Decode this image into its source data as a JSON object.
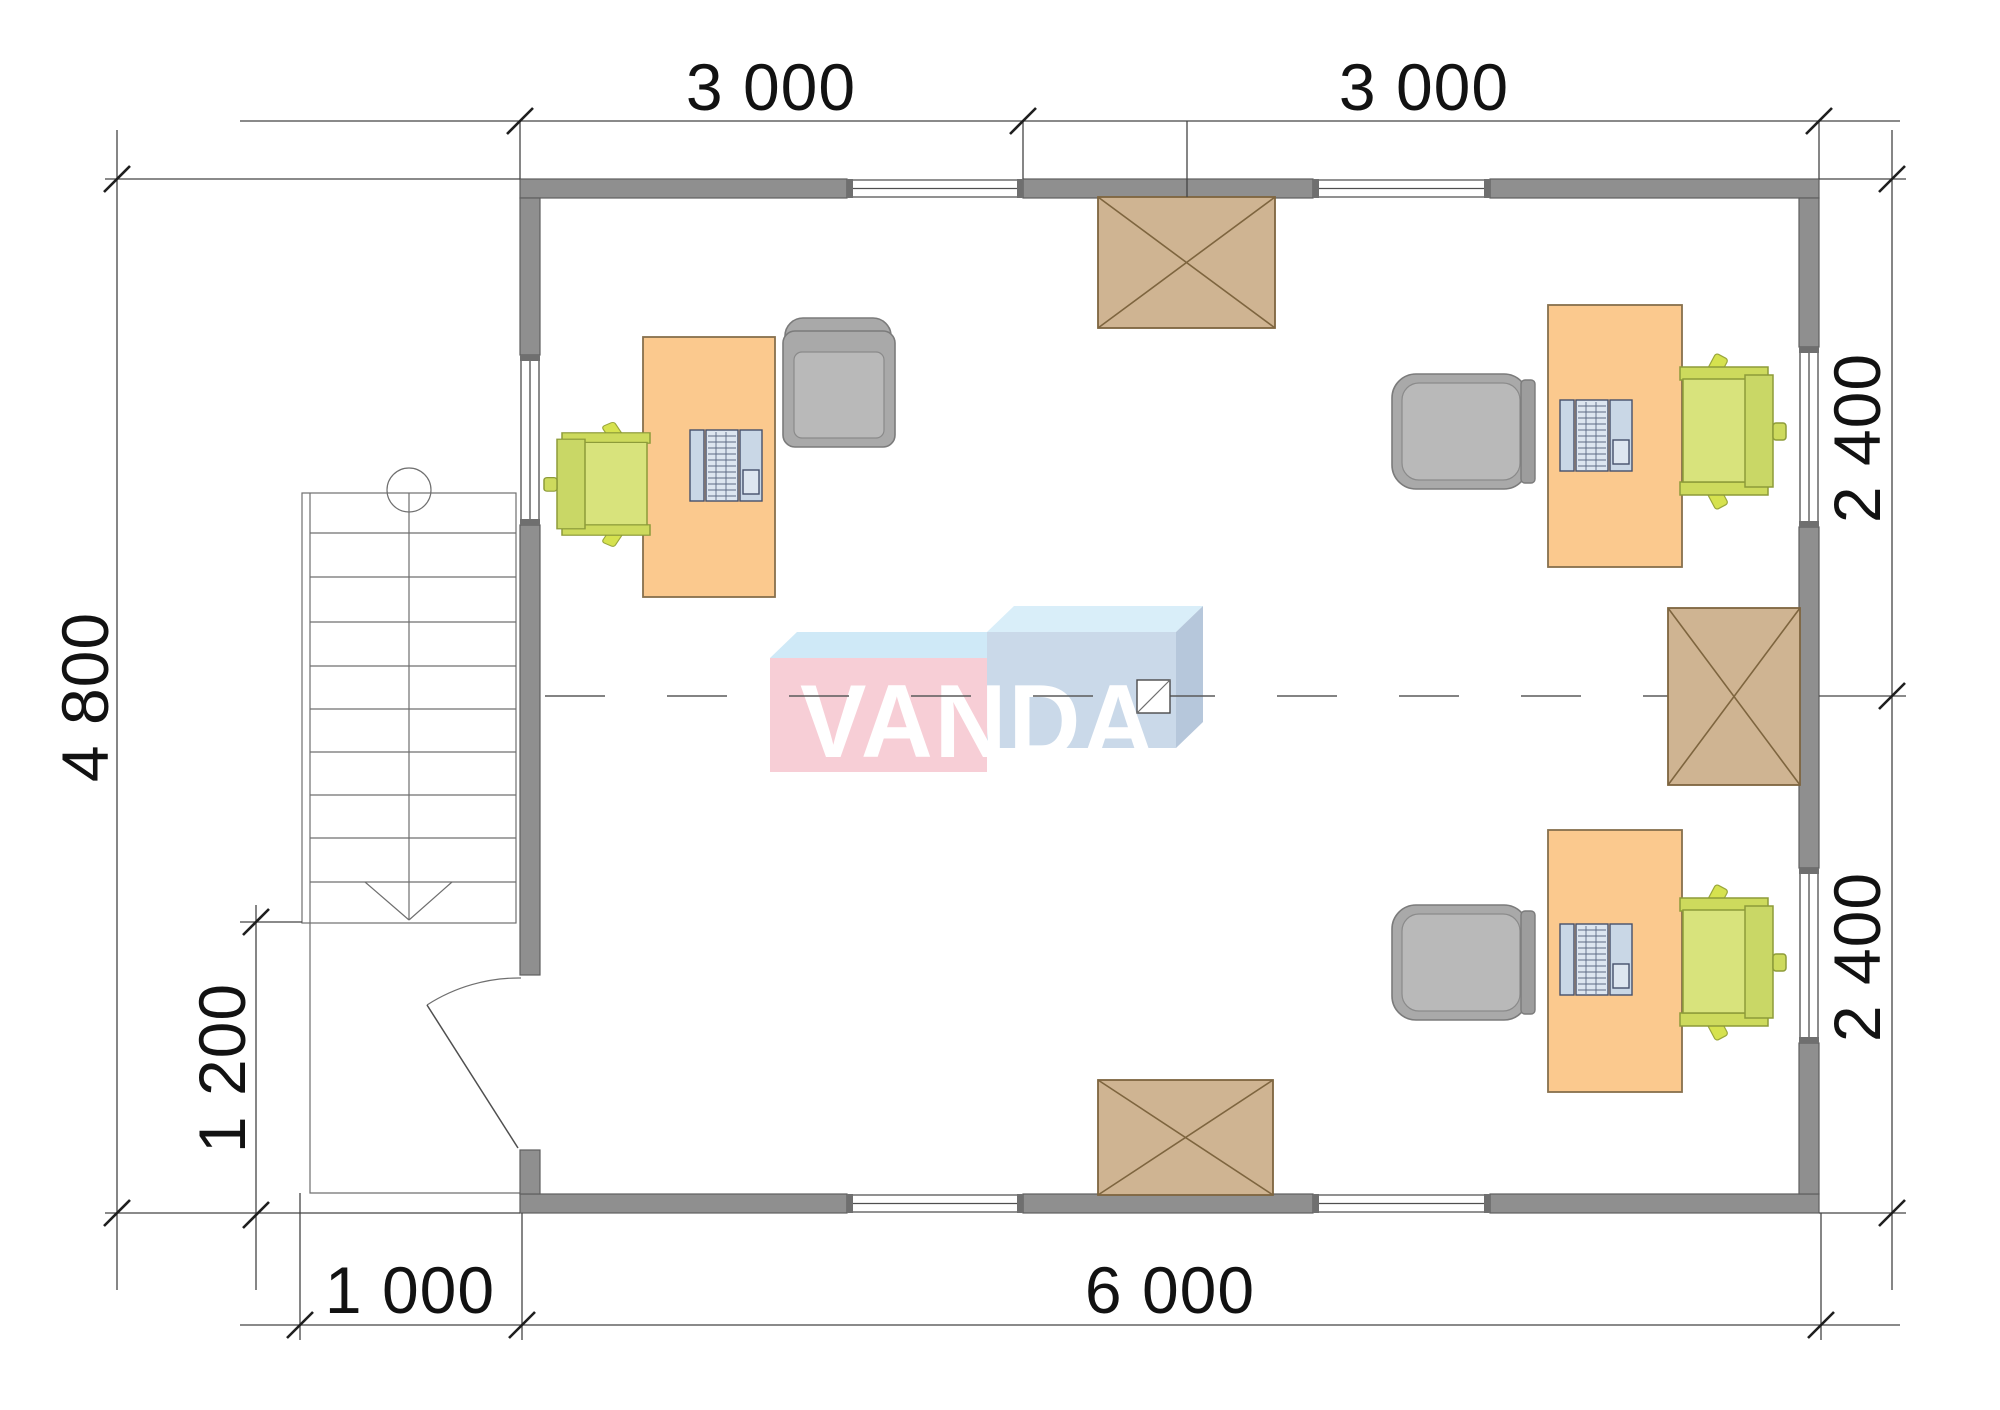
{
  "plan": {
    "title": "office-floor-plan",
    "brand": {
      "logo_text": "VANDA"
    },
    "dimensions": {
      "top": [
        {
          "label": "3 000"
        },
        {
          "label": "3 000"
        }
      ],
      "right": [
        {
          "label": "2 400"
        },
        {
          "label": "2 400"
        }
      ],
      "left": [
        {
          "label": "4 800"
        },
        {
          "label": "1 200"
        }
      ],
      "bottom": [
        {
          "label": "1 000"
        },
        {
          "label": "6 000"
        }
      ]
    },
    "rooms": {
      "workstations": 3,
      "roof_hatches": 3,
      "staircase_steps": 10
    }
  },
  "colors": {
    "wall": "#8f8f8f",
    "desk": "#fbc98e",
    "chair_green": "#d8e37c",
    "chair_gray": "#a9a9a9",
    "hatch": "#cfb492",
    "logo_pink": "#f7ced6",
    "logo_blue": "#cad9e9",
    "logo_top": "#cfe9f7",
    "dimension_text": "#121212"
  }
}
